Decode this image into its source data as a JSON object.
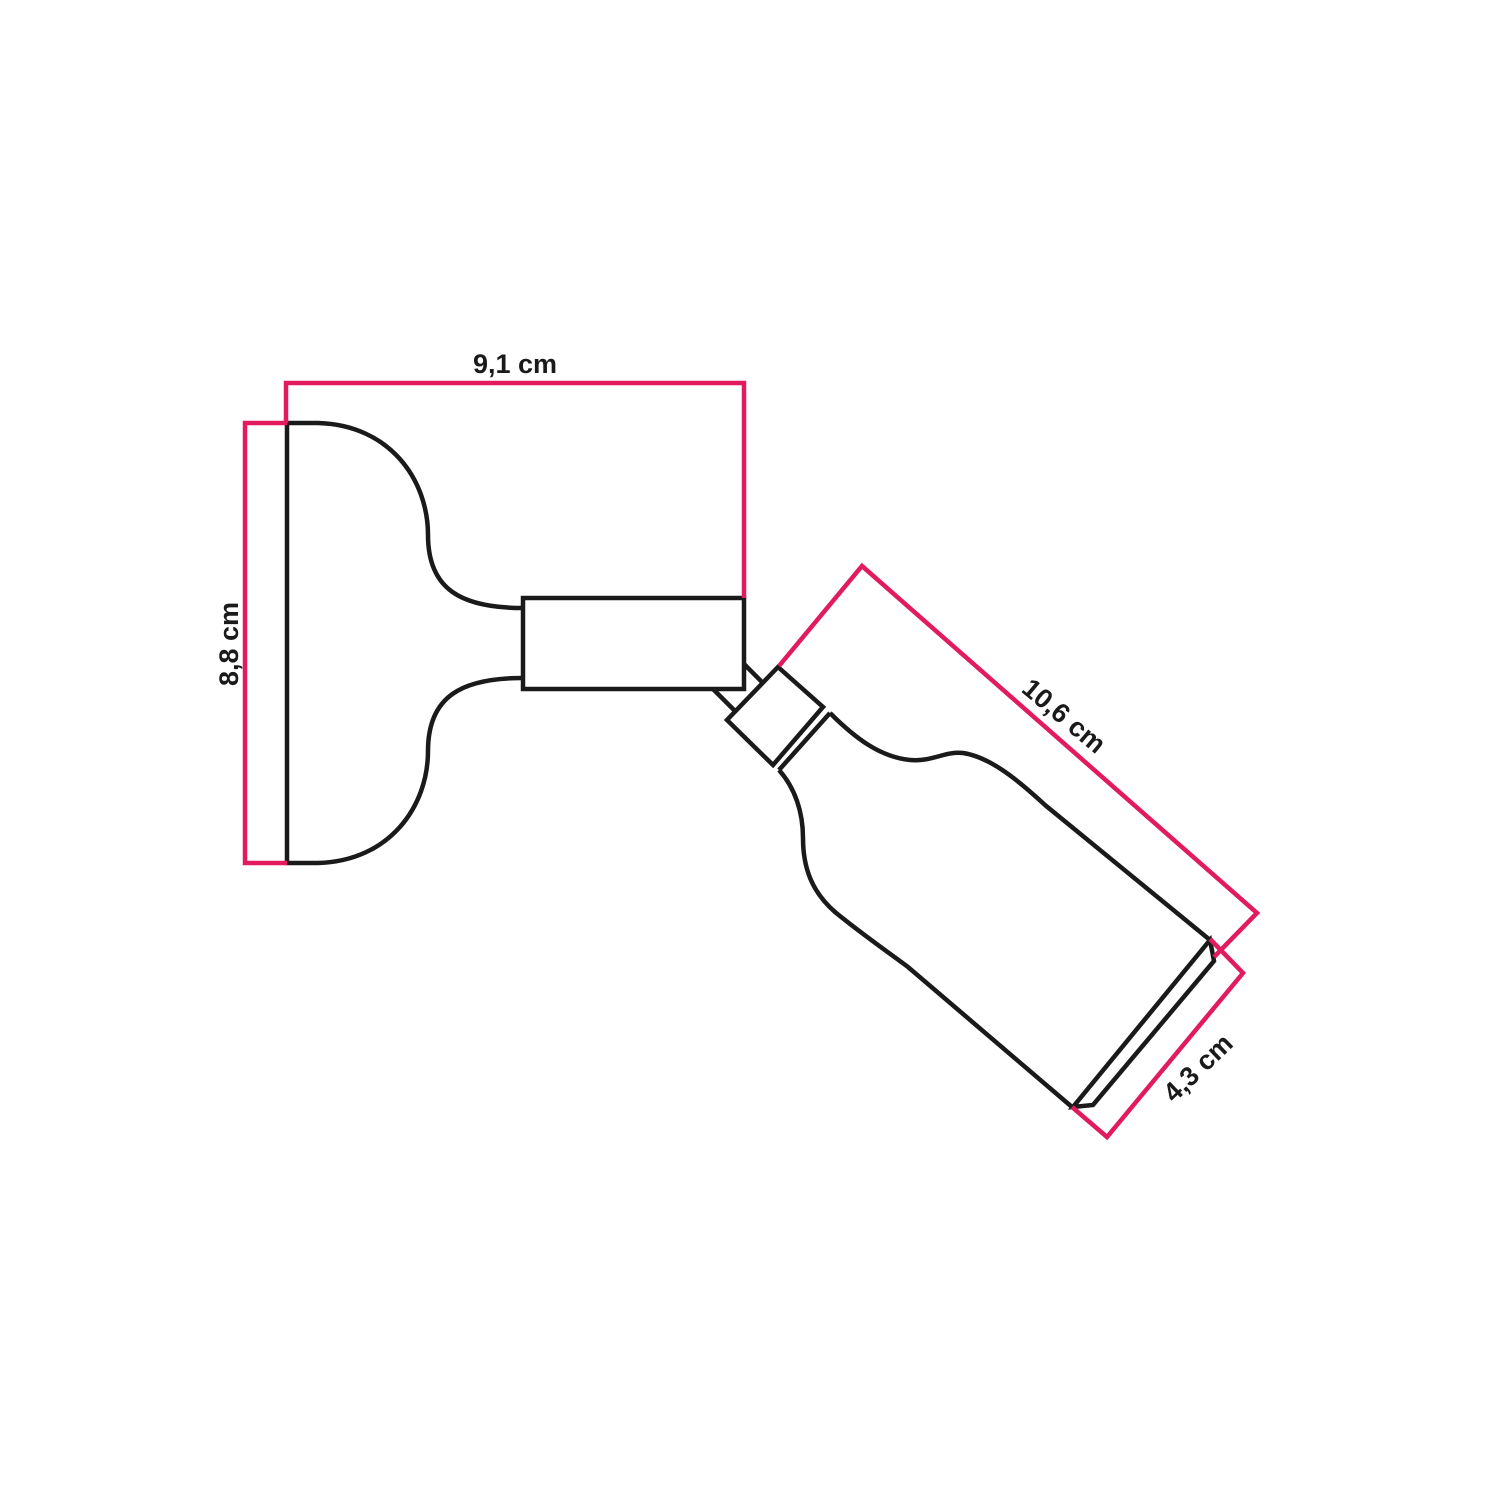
{
  "diagram": {
    "labels": {
      "base_width": "9,1 cm",
      "base_height": "8,8 cm",
      "holder_length": "10,6 cm",
      "holder_diameter": "4,3 cm"
    },
    "colors": {
      "outline": "#1a1a1a",
      "dimension_line": "#e21a5e",
      "background": "#ffffff"
    }
  }
}
